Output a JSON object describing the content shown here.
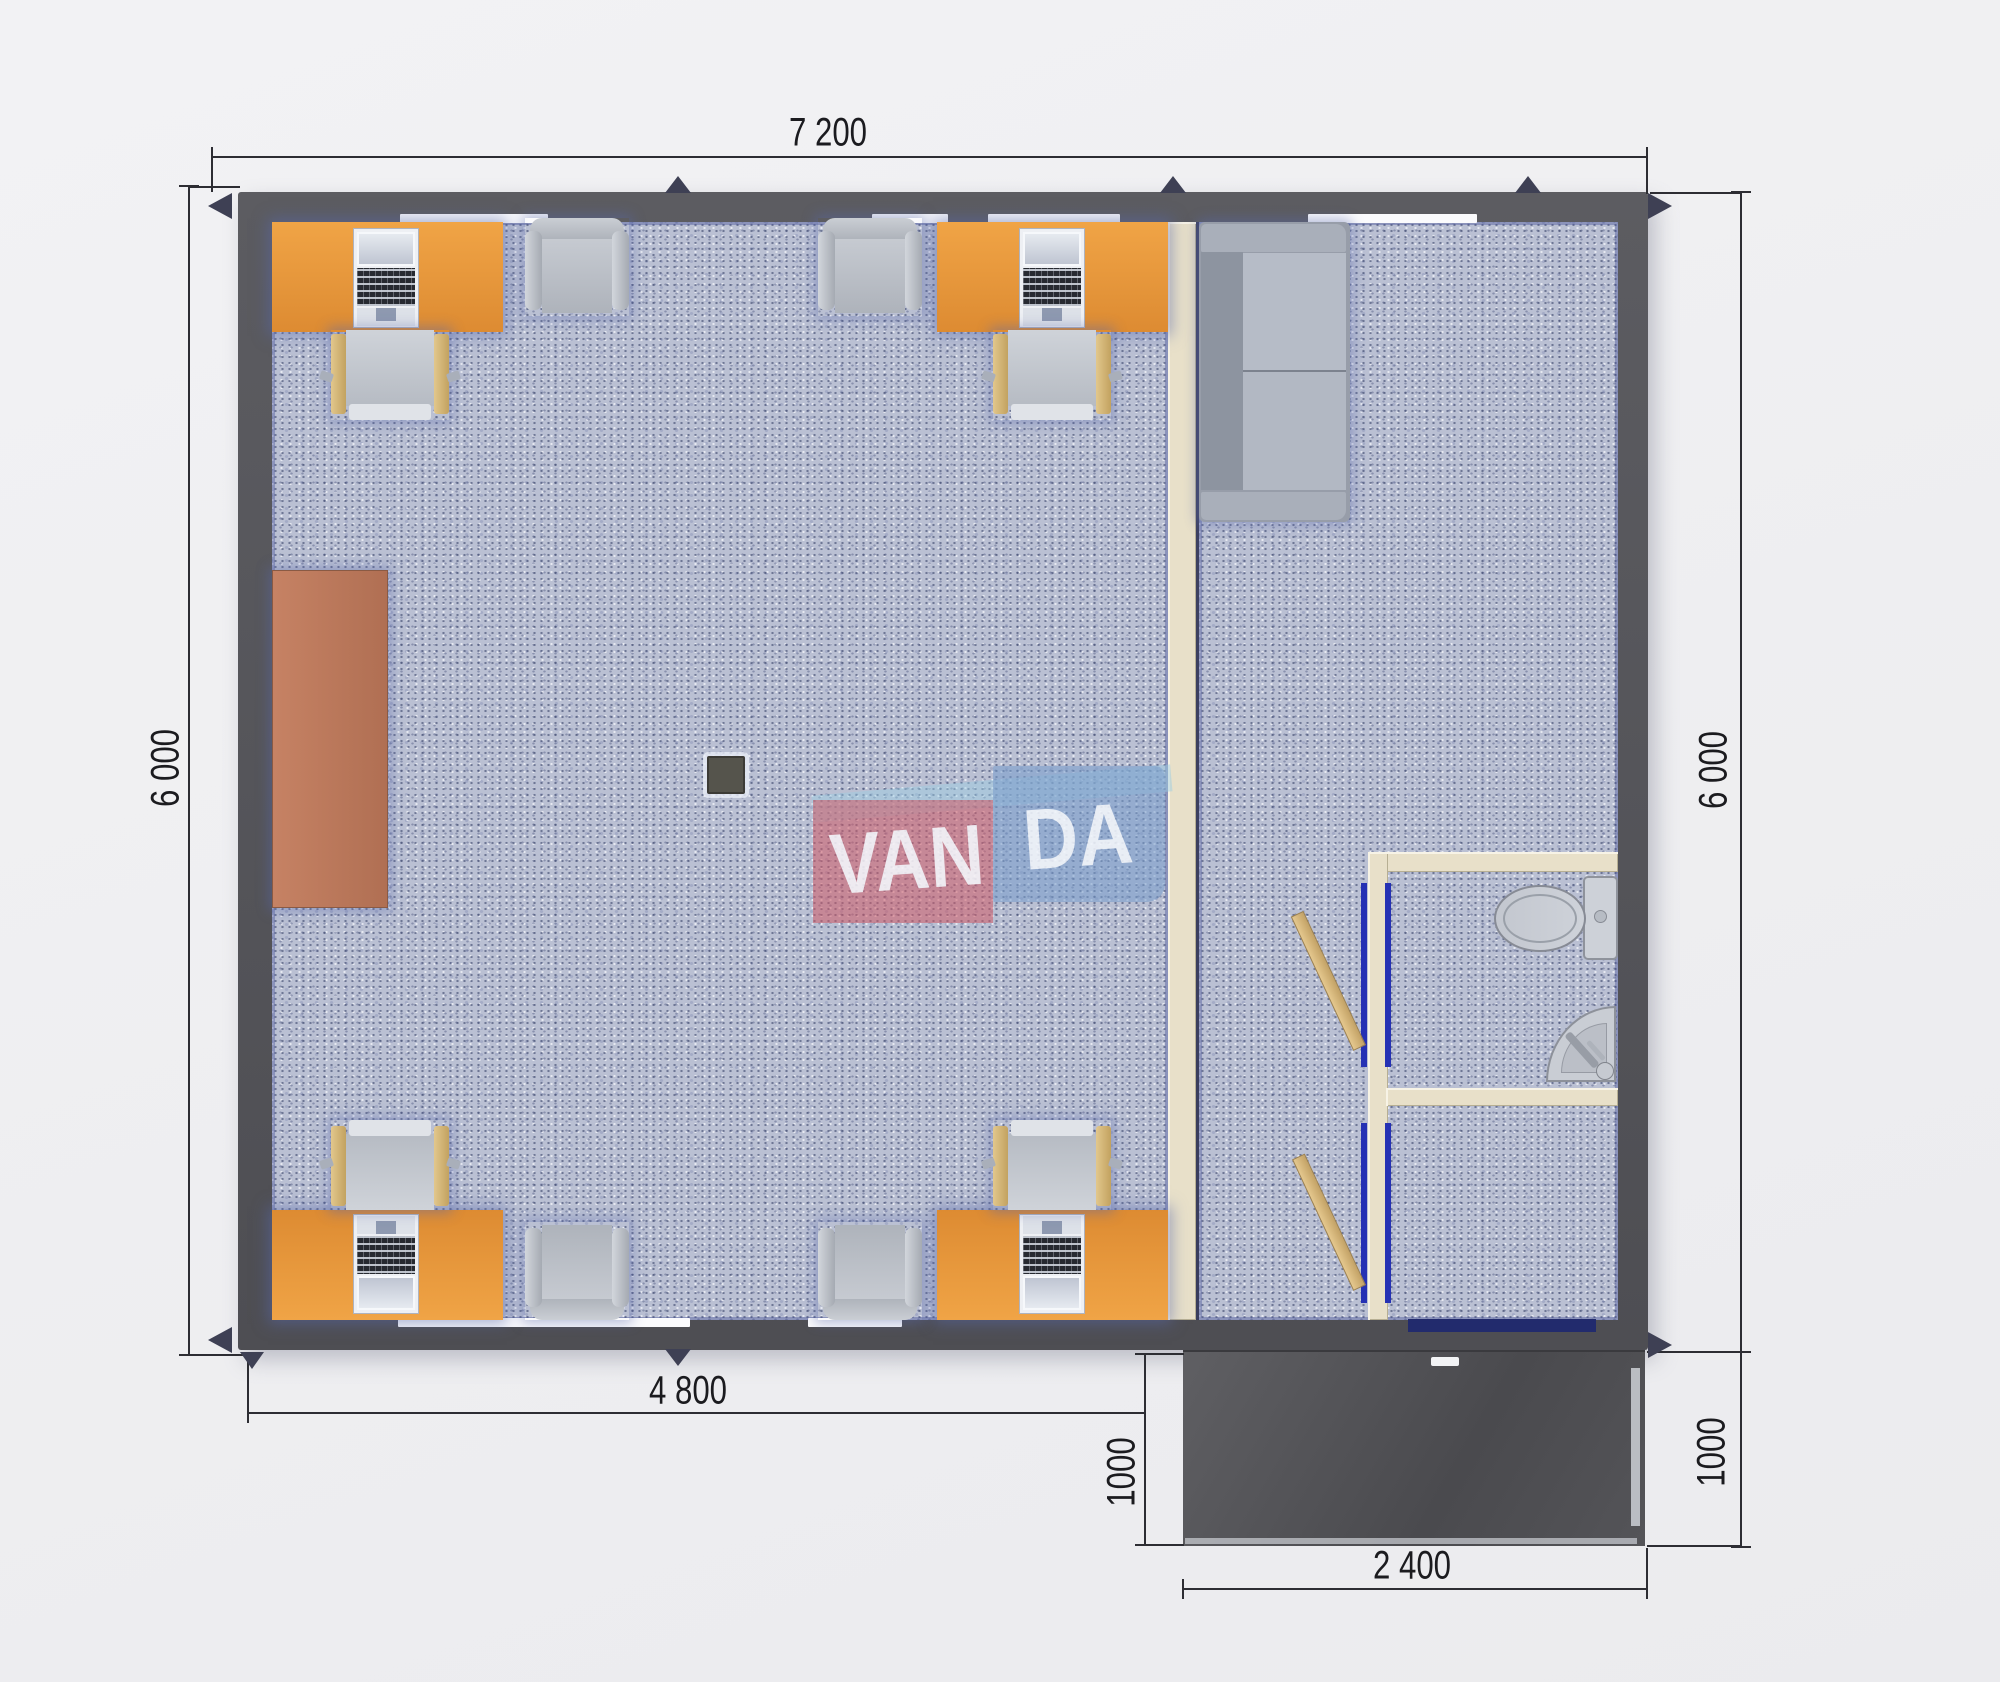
{
  "watermark": {
    "van": "VAN",
    "da": "DA"
  },
  "dimensions": {
    "overall_width": "7 200",
    "left_height": "6 000",
    "right_height": "6 000",
    "office_width": "4 800",
    "porch_depth_left": "1000",
    "porch_depth_right": "1000",
    "porch_width": "2 400"
  },
  "colors": {
    "wall": "#55555a",
    "carpet": "#bac0d3",
    "desk_orange": "#e59638",
    "cabinet_terracotta": "#bd7a5c",
    "partition_cream": "#e8e0c9",
    "porch_dark": "#505054",
    "door_wood": "#d4b277",
    "door_frame_blue": "#2531b4",
    "logo_red": "#d25c68",
    "logo_blue": "#789ecd"
  },
  "objects": {
    "desks": 4,
    "desk_chairs": 4,
    "visitor_chairs": 4,
    "cabinet": 1,
    "sofa": 1,
    "toilet": 1,
    "sink": 1,
    "column": 1,
    "porch": 1
  }
}
